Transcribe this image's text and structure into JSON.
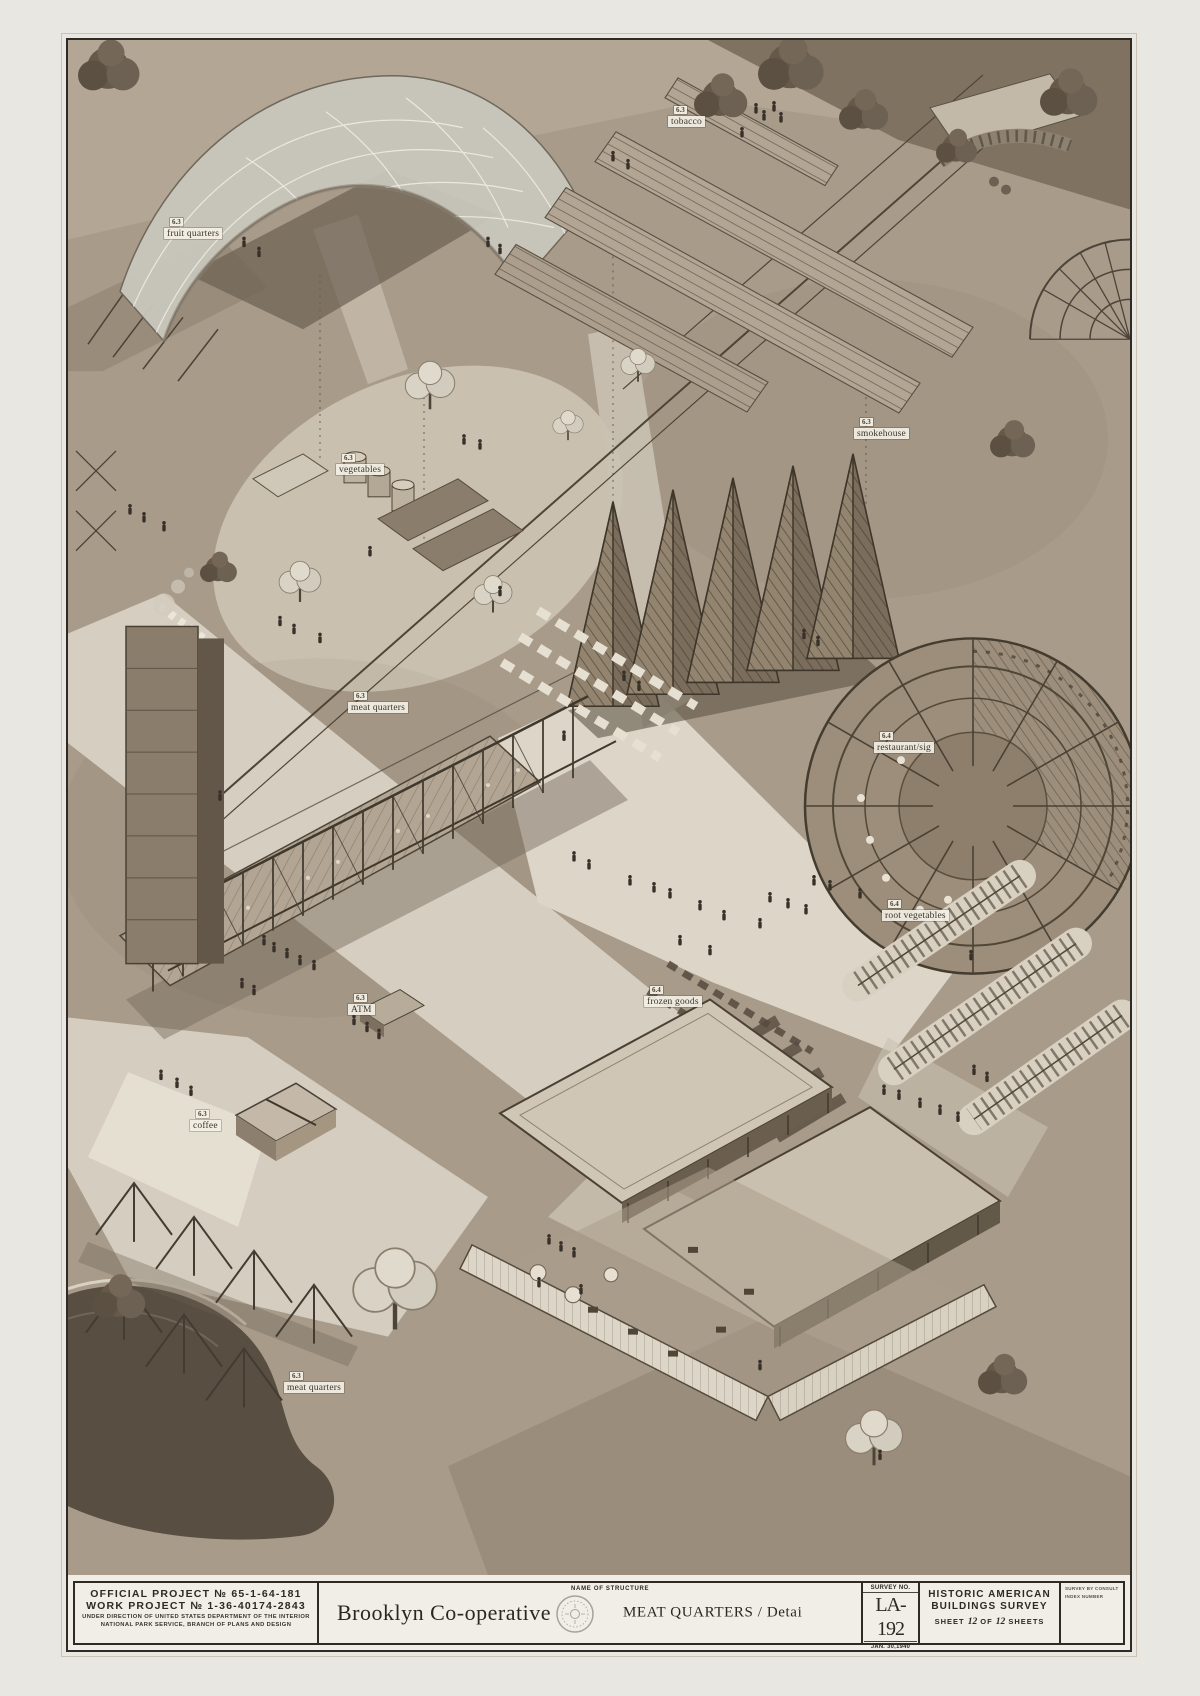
{
  "colors": {
    "paper": "#efede6",
    "ground": "#aca08f",
    "ink": "#2f2b24",
    "label_bg": "#f3efe5",
    "dark_roof": "#3e362b"
  },
  "drawing": {
    "labels": [
      {
        "id": "fruit-quarters",
        "tag": "6.3",
        "text": "fruit quarters",
        "x": 96,
        "y": 178
      },
      {
        "id": "tobacco",
        "tag": "6.3",
        "text": "tobacco",
        "x": 600,
        "y": 66
      },
      {
        "id": "vegetables",
        "tag": "6.3",
        "text": "vegetables",
        "x": 268,
        "y": 414
      },
      {
        "id": "smokehouse",
        "tag": "6.3",
        "text": "smokehouse",
        "x": 786,
        "y": 378
      },
      {
        "id": "meat-quarters",
        "tag": "6.3",
        "text": "meat quarters",
        "x": 280,
        "y": 652
      },
      {
        "id": "restaurant",
        "tag": "6.4",
        "text": "restaurant/sig",
        "x": 806,
        "y": 692
      },
      {
        "id": "root-vegetables",
        "tag": "6.4",
        "text": "root vegetables",
        "x": 814,
        "y": 860
      },
      {
        "id": "frozen-goods",
        "tag": "6.4",
        "text": "frozen goods",
        "x": 576,
        "y": 946
      },
      {
        "id": "atm",
        "tag": "6.3",
        "text": "ATM",
        "x": 280,
        "y": 954
      },
      {
        "id": "coffee",
        "tag": "6.3",
        "text": "coffee",
        "x": 122,
        "y": 1070
      },
      {
        "id": "meat-quarters-south",
        "tag": "6.3",
        "text": "meat quarters",
        "x": 216,
        "y": 1332
      }
    ],
    "trees": [
      {
        "x": 40,
        "y": 28,
        "s": 1.5,
        "t": "d"
      },
      {
        "x": 652,
        "y": 58,
        "s": 1.3,
        "t": "d"
      },
      {
        "x": 722,
        "y": 26,
        "s": 1.6,
        "t": "d"
      },
      {
        "x": 795,
        "y": 72,
        "s": 1.2,
        "t": "d"
      },
      {
        "x": 888,
        "y": 108,
        "s": 1.0,
        "t": "d"
      },
      {
        "x": 1000,
        "y": 55,
        "s": 1.4,
        "t": "d"
      },
      {
        "x": 362,
        "y": 352,
        "s": 1.3,
        "t": "l"
      },
      {
        "x": 232,
        "y": 548,
        "s": 1.1,
        "t": "l"
      },
      {
        "x": 150,
        "y": 530,
        "s": 0.9,
        "t": "d"
      },
      {
        "x": 425,
        "y": 560,
        "s": 1.0,
        "t": "l"
      },
      {
        "x": 944,
        "y": 402,
        "s": 1.1,
        "t": "d"
      },
      {
        "x": 327,
        "y": 1262,
        "s": 2.2,
        "t": "l"
      },
      {
        "x": 50,
        "y": 1262,
        "s": 1.3,
        "t": "d"
      },
      {
        "x": 806,
        "y": 1408,
        "s": 1.5,
        "t": "l"
      },
      {
        "x": 934,
        "y": 1340,
        "s": 1.2,
        "t": "d"
      },
      {
        "x": 570,
        "y": 330,
        "s": 0.9,
        "t": "l"
      },
      {
        "x": 500,
        "y": 390,
        "s": 0.8,
        "t": "l"
      }
    ],
    "figures": [
      [
        688,
        72
      ],
      [
        696,
        79
      ],
      [
        706,
        70
      ],
      [
        713,
        81
      ],
      [
        674,
        96
      ],
      [
        420,
        206
      ],
      [
        432,
        213
      ],
      [
        62,
        474
      ],
      [
        76,
        482
      ],
      [
        96,
        491
      ],
      [
        212,
        586
      ],
      [
        226,
        594
      ],
      [
        252,
        603
      ],
      [
        396,
        404
      ],
      [
        412,
        409
      ],
      [
        302,
        516
      ],
      [
        432,
        556
      ],
      [
        506,
        822
      ],
      [
        521,
        830
      ],
      [
        562,
        846
      ],
      [
        586,
        853
      ],
      [
        602,
        859
      ],
      [
        632,
        871
      ],
      [
        656,
        881
      ],
      [
        692,
        889
      ],
      [
        702,
        863
      ],
      [
        720,
        869
      ],
      [
        738,
        875
      ],
      [
        612,
        906
      ],
      [
        642,
        916
      ],
      [
        746,
        846
      ],
      [
        762,
        851
      ],
      [
        792,
        859
      ],
      [
        196,
        906
      ],
      [
        206,
        913
      ],
      [
        219,
        919
      ],
      [
        232,
        926
      ],
      [
        246,
        931
      ],
      [
        186,
        956
      ],
      [
        174,
        949
      ],
      [
        286,
        986
      ],
      [
        299,
        993
      ],
      [
        311,
        1000
      ],
      [
        93,
        1041
      ],
      [
        109,
        1049
      ],
      [
        123,
        1057
      ],
      [
        816,
        1056
      ],
      [
        831,
        1061
      ],
      [
        852,
        1069
      ],
      [
        872,
        1076
      ],
      [
        890,
        1083
      ],
      [
        906,
        1036
      ],
      [
        919,
        1043
      ],
      [
        481,
        1206
      ],
      [
        493,
        1213
      ],
      [
        506,
        1219
      ],
      [
        471,
        1249
      ],
      [
        513,
        1256
      ],
      [
        812,
        1422
      ],
      [
        692,
        1332
      ],
      [
        736,
        599
      ],
      [
        750,
        606
      ],
      [
        152,
        761
      ],
      [
        176,
        206
      ],
      [
        191,
        216
      ],
      [
        556,
        641
      ],
      [
        571,
        651
      ],
      [
        496,
        701
      ],
      [
        903,
        921
      ],
      [
        545,
        120
      ],
      [
        560,
        128
      ]
    ]
  },
  "title_block": {
    "official_project": "OFFICIAL PROJECT № 65-1-64-181",
    "work_project": "WORK PROJECT № 1-36-40174-2843",
    "direction_line1": "UNDER DIRECTION OF UNITED STATES DEPARTMENT OF THE INTERIOR",
    "direction_line2": "NATIONAL PARK SERVICE, BRANCH OF PLANS AND DESIGN",
    "structure_name": "Brooklyn Co-operative",
    "name_of_structure_label": "NAME OF STRUCTURE",
    "drawing_title": "MEAT QUARTERS / Detai",
    "survey_no_label": "SURVEY NO.",
    "survey_no": "LA-192",
    "survey_date": "JAN. 30,1940",
    "habs_line1": "HISTORIC AMERICAN",
    "habs_line2": "BUILDINGS SURVEY",
    "sheet_prefix": "SHEET",
    "sheet_num": "12",
    "sheet_of": "OF",
    "sheet_total": "12",
    "sheet_suffix": "SHEETS",
    "index_line1": "SURVEY BY CONSULT",
    "index_line2": "INDEX NUMBER"
  }
}
